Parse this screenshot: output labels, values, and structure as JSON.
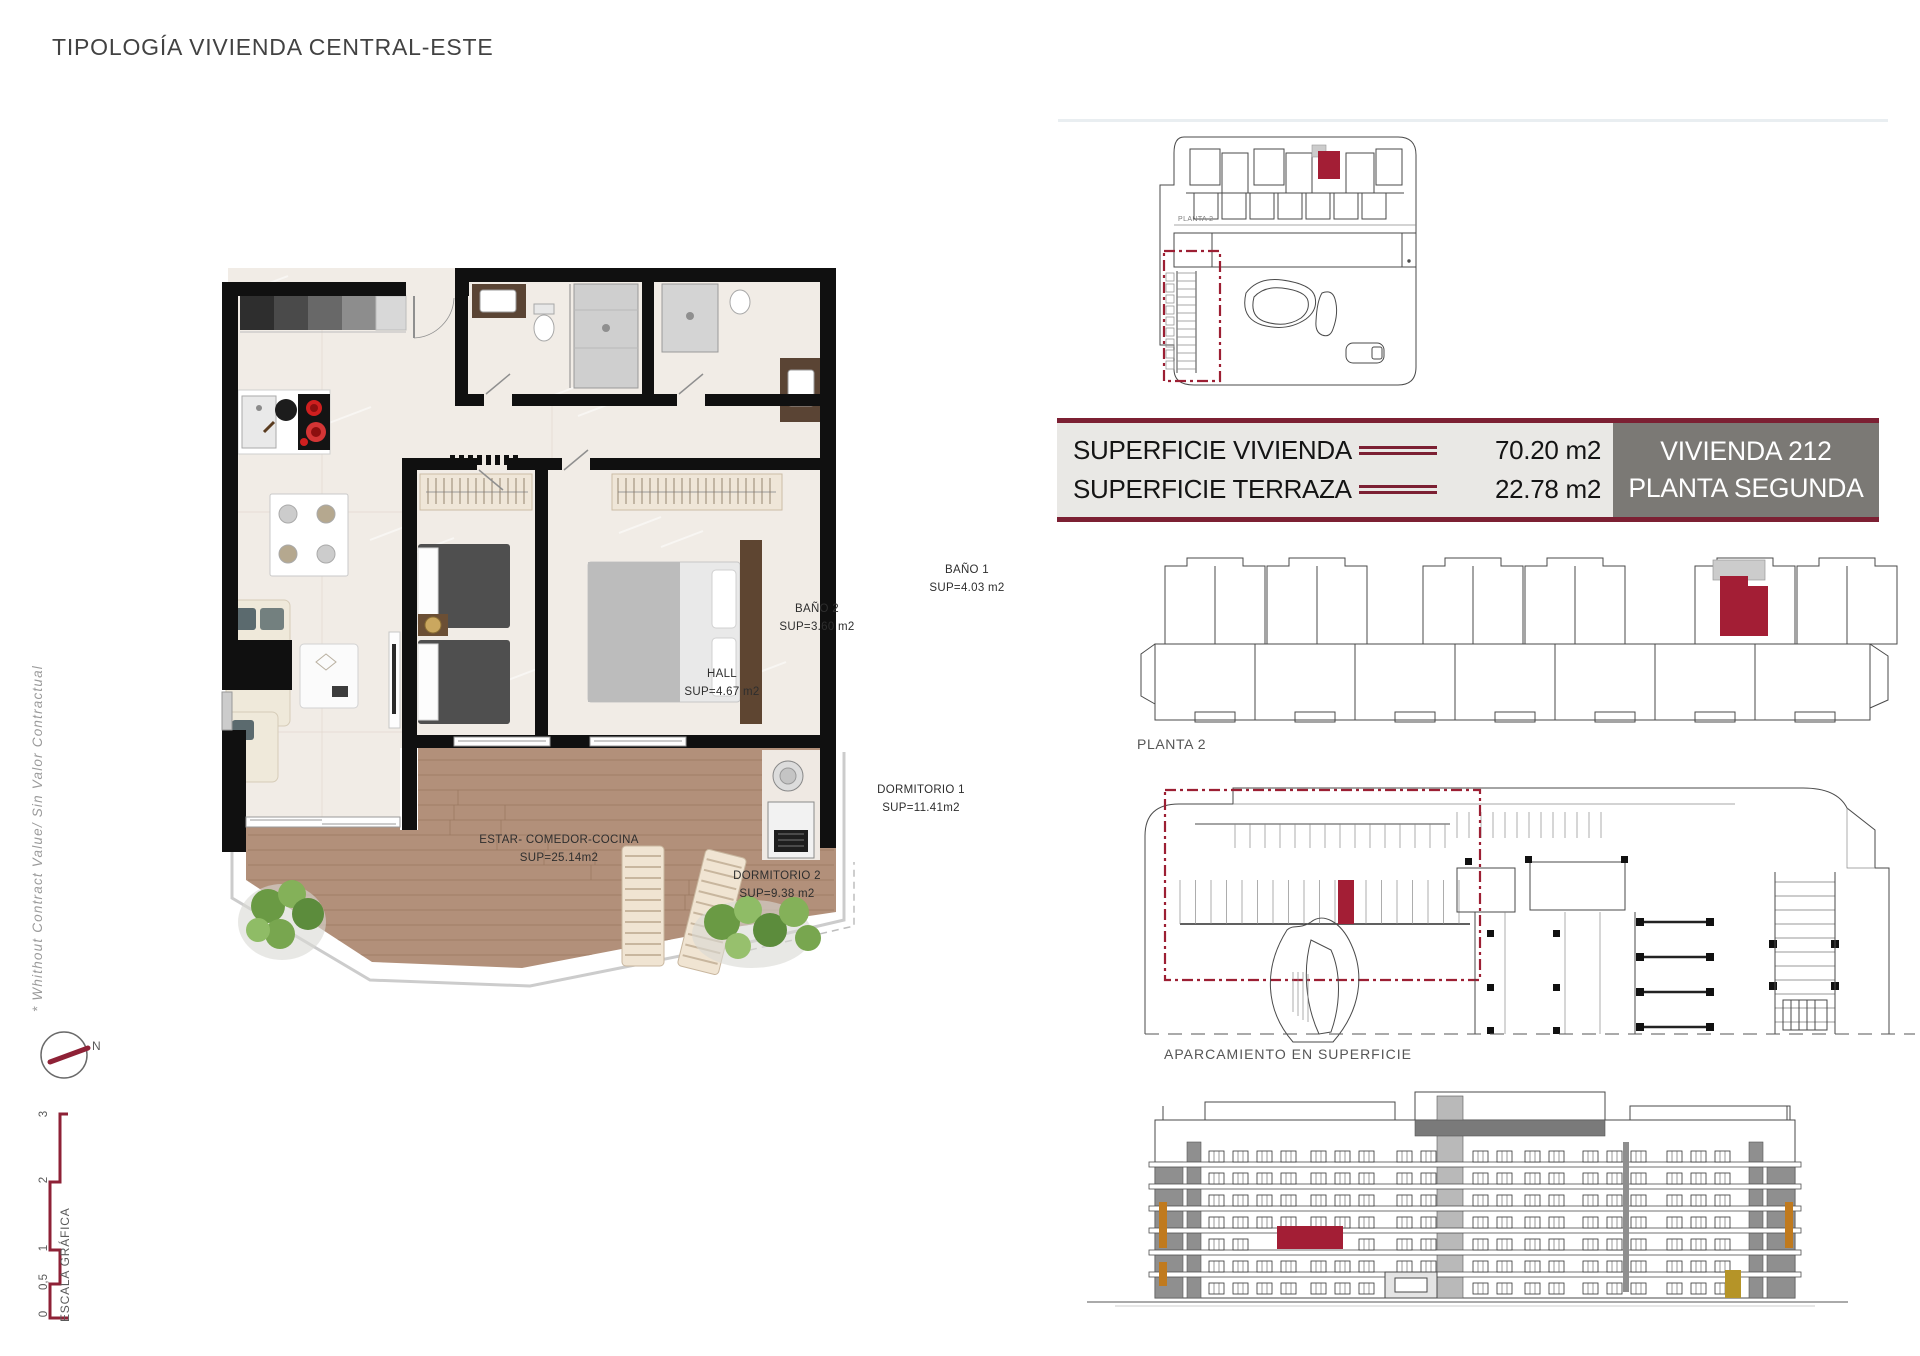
{
  "page": {
    "title": "TIPOLOGÍA VIVIENDA CENTRAL-ESTE",
    "side_note": "* Whithout Contract Value/ Sin Valor Contractual"
  },
  "floorplan": {
    "rooms": [
      {
        "name": "BAÑO 1",
        "sup": "SUP=4.03 m2"
      },
      {
        "name": "BAÑO 2",
        "sup": "SUP=3.60 m2"
      },
      {
        "name": "HALL",
        "sup": "SUP=4.67 m2"
      },
      {
        "name": "DORMITORIO 1",
        "sup": "SUP=11.41m2"
      },
      {
        "name": "DORMITORIO 2",
        "sup": "SUP=9.38 m2"
      },
      {
        "name": "ESTAR- COMEDOR-COCINA",
        "sup": "SUP=25.14m2"
      }
    ]
  },
  "summary": {
    "rows": [
      {
        "label": "SUPERFICIE VIVIENDA",
        "value": "70.20 m2"
      },
      {
        "label": "SUPERFICIE TERRAZA",
        "value": "22.78 m2"
      }
    ],
    "unit_line1": "VIVIENDA 212",
    "unit_line2": "PLANTA SEGUNDA"
  },
  "plans": {
    "keyplan_tag": "PLANTA 2",
    "planta2_label": "PLANTA 2",
    "parking_label": "APARCAMIENTO EN SUPERFICIE"
  },
  "compass": {
    "north": "N"
  },
  "scalebar": {
    "title": "ESCALA GRÁFICA",
    "ticks": [
      "0",
      "0,5",
      "1",
      "2",
      "3"
    ]
  },
  "colors": {
    "accent_red": "#a31e35",
    "maroon": "#7c2033",
    "panel_gray": "#7b7975",
    "panel_light": "#e9e8e5",
    "ink": "#4a4a4a"
  }
}
